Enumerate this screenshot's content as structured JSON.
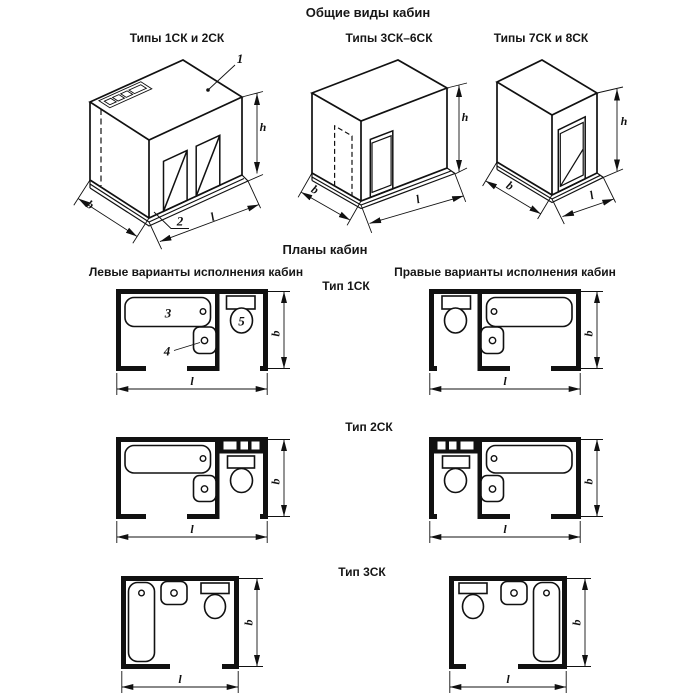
{
  "titles": {
    "main": "Общие виды кабин",
    "plans": "Планы кабин"
  },
  "general_views": [
    {
      "label": "Типы 1СК и 2СК"
    },
    {
      "label": "Типы 3СК–6СК"
    },
    {
      "label": "Типы 7СК и 8СК"
    }
  ],
  "variant_headers": {
    "left": "Левые варианты исполнения кабин",
    "right": "Правые варианты исполнения кабин"
  },
  "plan_types": [
    {
      "label": "Тип 1СК"
    },
    {
      "label": "Тип 2СК"
    },
    {
      "label": "Тип 3СК"
    }
  ],
  "dim_labels": {
    "width": "b",
    "length": "l",
    "height": "h"
  },
  "callouts": {
    "roof_panel": "1",
    "floor_panel": "2",
    "bath": "3",
    "washbasin": "4",
    "toilet": "5"
  }
}
